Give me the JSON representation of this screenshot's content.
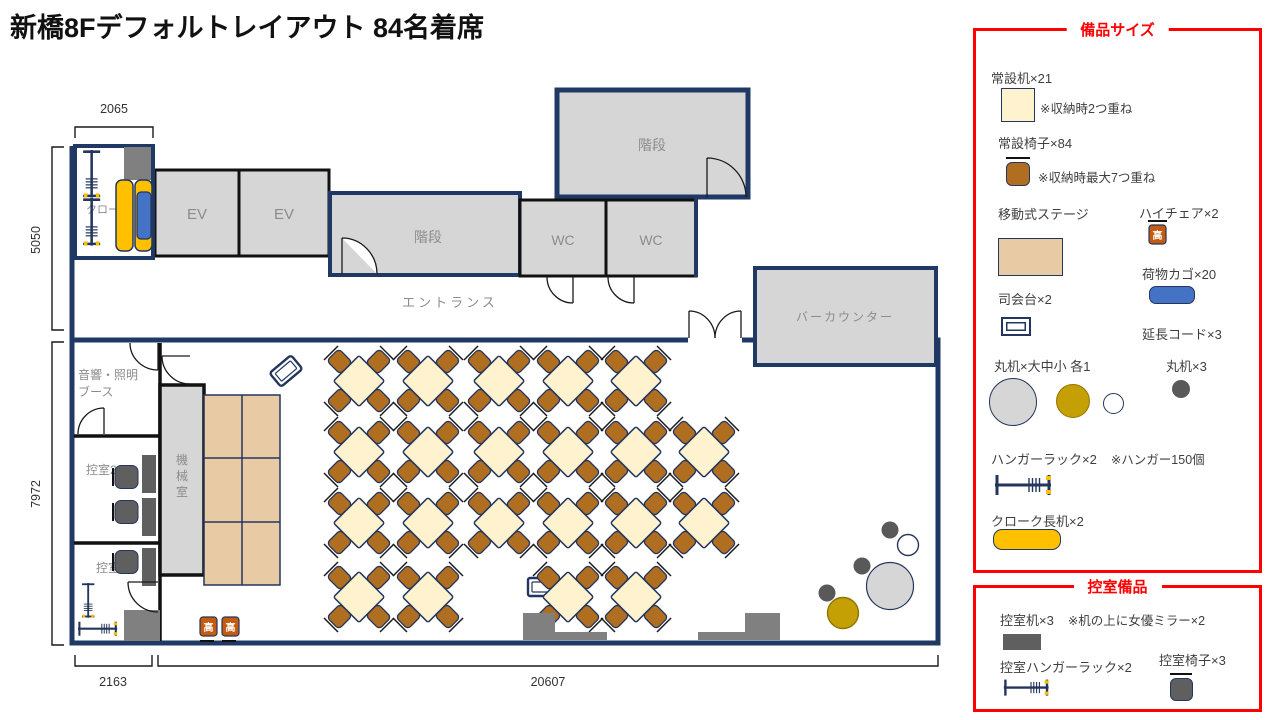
{
  "title": "新橋8Fデフォルトレイアウト 84名着席",
  "floor": {
    "rooms": {
      "cloak": "クローク",
      "ev1": "EV",
      "ev2": "EV",
      "stairs_mid": "階段",
      "stairs_top": "階段",
      "wc1": "WC",
      "wc2": "WC",
      "entrance": "エントランス",
      "bar": "バーカウンター",
      "booth_line1": "音響・照明",
      "booth_line2": "ブース",
      "waiting2": "控室2",
      "waiting1": "控室",
      "machine": [
        "機",
        "械",
        "室"
      ]
    },
    "dimensions": {
      "top": "2065",
      "left_upper": "5050",
      "left_lower": "7972",
      "bottom_left": "2163",
      "bottom_main": "20607"
    }
  },
  "equipment": {
    "high_chair_glyph": "高"
  },
  "legend_equipment": {
    "title": "備品サイズ",
    "items": [
      {
        "label": "常設机×21",
        "note": "※収納時2つ重ね"
      },
      {
        "label": "常設椅子×84",
        "note": "※収納時最大7つ重ね"
      },
      {
        "label": "移動式ステージ"
      },
      {
        "label": "ハイチェア×2"
      },
      {
        "label": "荷物カゴ×20"
      },
      {
        "label": "司会台×2"
      },
      {
        "label": "延長コード×3"
      },
      {
        "label": "丸机×大中小 各1"
      },
      {
        "label": "丸机×3"
      },
      {
        "label": "ハンガーラック×2",
        "note": "※ハンガー150個"
      },
      {
        "label": "クローク長机×2"
      }
    ]
  },
  "legend_waiting": {
    "title": "控室備品",
    "items": [
      {
        "label": "控室机×3",
        "note": "※机の上に女優ミラー×2"
      },
      {
        "label": "控室ハンガーラック×2"
      },
      {
        "label": "控室椅子×3"
      }
    ]
  }
}
